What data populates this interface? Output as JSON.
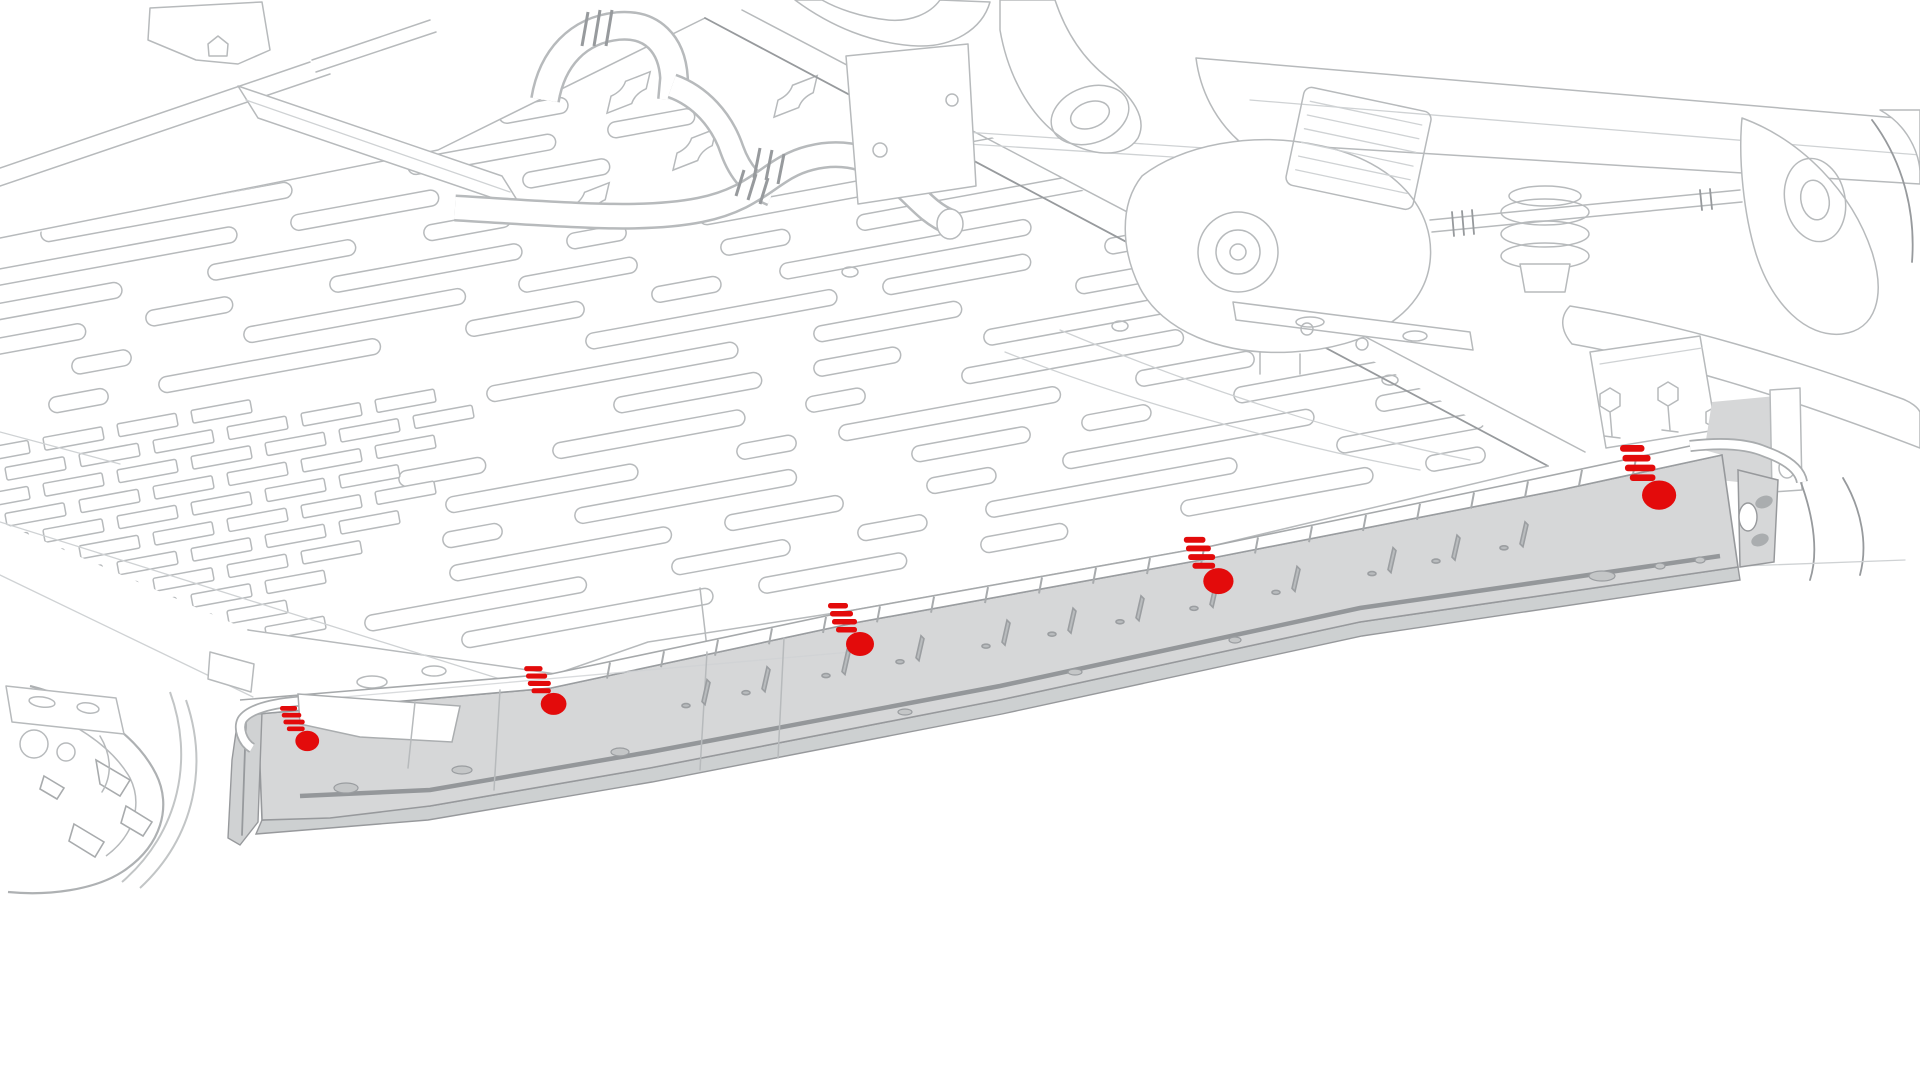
{
  "meta": {
    "description": "Underbody service illustration: rocker panel sill cover highlighted with fastener locations",
    "canvas": {
      "width": 1920,
      "height": 1080
    }
  },
  "illustration": {
    "colors": {
      "highlight_red": "#e30b0b",
      "part_fill_gray": "#d6d7d8",
      "part_edge_gray": "#97999c",
      "line_gray": "#b7babc",
      "line_light_gray": "#cfd2d4"
    },
    "highlighted_part": {
      "name": "rocker-panel-sill-cover",
      "fastener_count": 5
    },
    "fasteners": [
      {
        "id": "fastener-1",
        "x": 303,
        "y": 729,
        "scale": 0.85
      },
      {
        "id": "fastener-2",
        "x": 549,
        "y": 691,
        "scale": 0.92
      },
      {
        "id": "fastener-3",
        "x": 855,
        "y": 630,
        "scale": 1.0
      },
      {
        "id": "fastener-4",
        "x": 1213,
        "y": 566,
        "scale": 1.08
      },
      {
        "id": "fastener-5",
        "x": 1653,
        "y": 478,
        "scale": 1.22
      }
    ]
  }
}
